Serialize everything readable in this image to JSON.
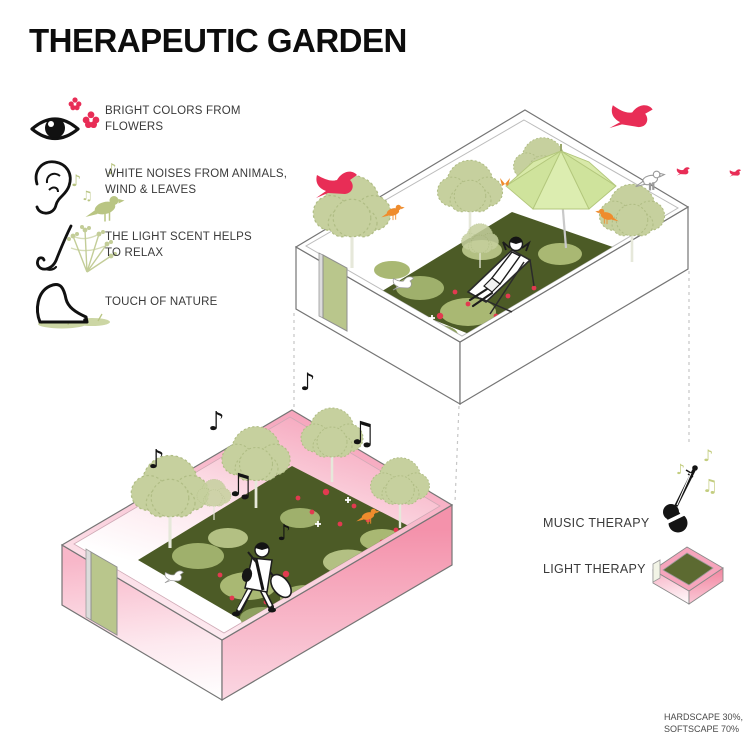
{
  "title": "THERAPEUTIC GARDEN",
  "senses": {
    "items": [
      {
        "icon": "eye-icon",
        "lines": [
          "BRIGHT COLORS FROM",
          "FLOWERS"
        ]
      },
      {
        "icon": "ear-icon",
        "lines": [
          "WHITE NOISES FROM ANIMALS,",
          "WIND & LEAVES"
        ]
      },
      {
        "icon": "nose-icon",
        "lines": [
          "THE LIGHT SCENT HELPS",
          "TO RELAX"
        ]
      },
      {
        "icon": "foot-icon",
        "lines": [
          "TOUCH OF NATURE",
          ""
        ]
      }
    ]
  },
  "legend": {
    "music_label": "MUSIC THERAPY",
    "light_label": "LIGHT THERAPY"
  },
  "footnote": {
    "lines": [
      "HARDSCAPE 30%,",
      "SOFTSCAPE 70%"
    ]
  },
  "glyphs": {
    "eighth_note": "♪",
    "beamed_note": "♫"
  },
  "colors": {
    "title_black": "#0d0d0d",
    "label_gray": "#3a3a3a",
    "accent_crimson": "#e82d56",
    "bird_orange": "#ef8c2d",
    "foliage_sage": "#c6d09e",
    "foliage_olive": "#b9c583",
    "ground_dark": "#4c5b26",
    "flower_red": "#e23a50",
    "wall_pink": "#f492ab",
    "umbrella_green": "#dcedb0",
    "note_black": "#141414",
    "outline_gray": "#757575"
  }
}
